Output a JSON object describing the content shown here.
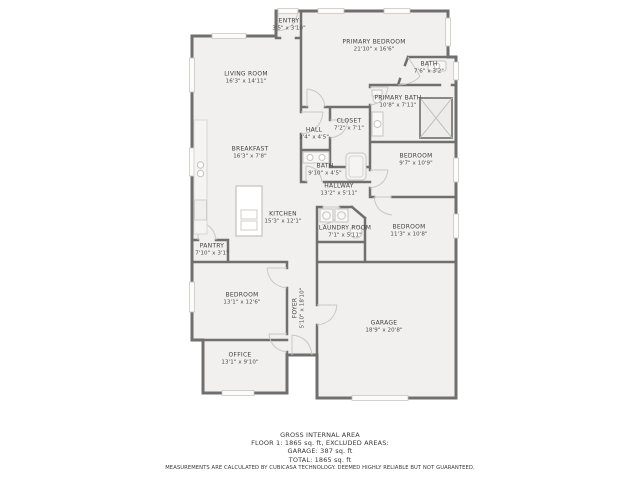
{
  "colors": {
    "wall": "#6f6f6f",
    "room_fill": "#f1f0ee",
    "fixture_line": "#c6c4c1",
    "label_text": "#3e3e3e"
  },
  "rooms": {
    "entry": {
      "name": "ENTRY",
      "dims": "3'5\" x 3'10\""
    },
    "primary_bedroom": {
      "name": "PRIMARY BEDROOM",
      "dims": "21'10\" x 16'6\""
    },
    "bath_top": {
      "name": "BATH",
      "dims": "7'6\" x 3'2\""
    },
    "primary_bath": {
      "name": "PRIMARY BATH",
      "dims": "10'8\" x 7'11\""
    },
    "living_room": {
      "name": "LIVING ROOM",
      "dims": "16'3\" x 14'11\""
    },
    "closet": {
      "name": "CLOSET",
      "dims": "7'2\" x 7'1\""
    },
    "hall": {
      "name": "HALL",
      "dims": "3'4\" x 4'5\""
    },
    "bath_mid": {
      "name": "BATH",
      "dims": "9'10\" x 4'5\""
    },
    "hallway": {
      "name": "HALLWAY",
      "dims": "13'2\" x 5'11\""
    },
    "bedroom_mid_right": {
      "name": "BEDROOM",
      "dims": "9'7\" x 10'9\""
    },
    "breakfast": {
      "name": "BREAKFAST",
      "dims": "16'3\" x 7'8\""
    },
    "kitchen": {
      "name": "KITCHEN",
      "dims": "15'3\" x 12'1\""
    },
    "laundry_room": {
      "name": "LAUNDRY ROOM",
      "dims": "7'1\" x 5'11\""
    },
    "bedroom_lower_right": {
      "name": "BEDROOM",
      "dims": "11'3\" x 10'8\""
    },
    "pantry": {
      "name": "PANTRY",
      "dims": "7'10\" x 3'1\""
    },
    "bedroom_left": {
      "name": "BEDROOM",
      "dims": "13'1\" x 12'6\""
    },
    "foyer": {
      "name": "FOYER",
      "dims": "5'10\" x 18'10\""
    },
    "office": {
      "name": "OFFICE",
      "dims": "13'1\" x 9'10\""
    },
    "garage": {
      "name": "GARAGE",
      "dims": "18'9\" x 20'8\""
    }
  },
  "footer": {
    "lines": [
      "GROSS INTERNAL AREA",
      "FLOOR 1: 1865 sq. ft, EXCLUDED AREAS:",
      "GARAGE: 387 sq. ft",
      "TOTAL: 1865 sq. ft",
      "MEASUREMENTS ARE CALCULATED BY CUBICASA TECHNOLOGY. DEEMED HIGHLY RELIABLE BUT NOT GUARANTEED."
    ]
  }
}
